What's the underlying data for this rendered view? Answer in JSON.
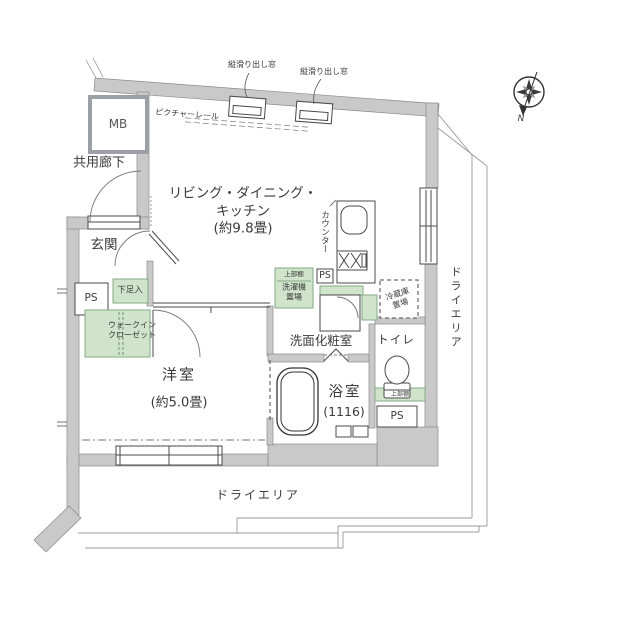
{
  "labels": {
    "mb": "MB",
    "common_corridor": "共用廊下",
    "entrance": "玄関",
    "ps_entrance": "PS",
    "shoe_box": "下足入",
    "walk_in_closet": "ウォークイン\nクローゼット",
    "western_room": "洋室",
    "western_room_size": "(約5.0畳)",
    "ldk": "リビング・ダイニング・\nキッチン\n(約9.8畳)",
    "counter": "カウンター",
    "picture_rail": "ピクチャーレール",
    "casement_window_left": "縦滑り出し窓",
    "casement_window_right": "縦滑り出し窓",
    "washer_shelf": "上部棚",
    "washer": "洗濯機\n置場",
    "fridge": "冷蔵庫\n置場",
    "ps_kitchen": "PS",
    "washroom": "洗面化粧室",
    "toilet": "トイレ",
    "toilet_shelf": "上部棚",
    "ps_lower": "PS",
    "bathroom": "浴室",
    "bathroom_size": "(1116)",
    "dry_area_right": "ドライエリア",
    "dry_area_bottom": "ドライエリア",
    "compass_n": "N"
  },
  "colors": {
    "wall_fill": "#c9c9c9",
    "wall_edge": "#8a8a8a",
    "fixture_green": "#cfe4cb",
    "fixture_green_edge": "#86ab86",
    "line": "#4a4a4a",
    "site_line": "#999999"
  }
}
